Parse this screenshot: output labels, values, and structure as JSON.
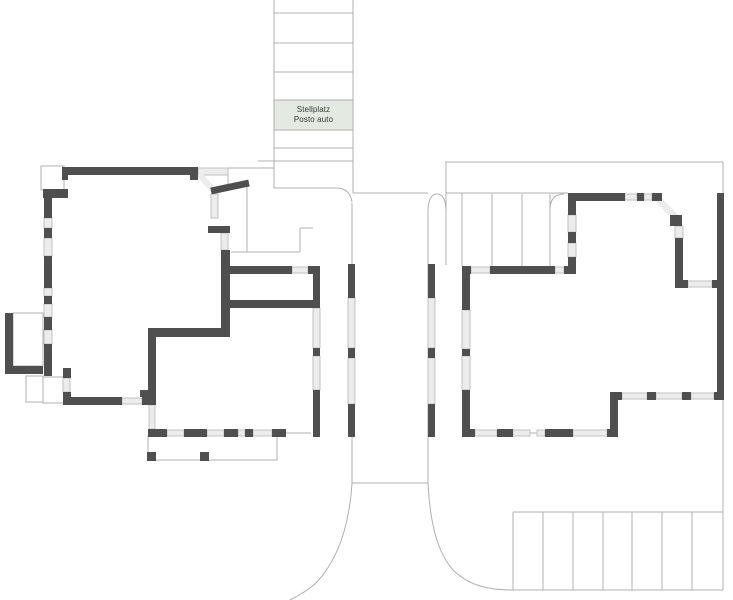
{
  "plan": {
    "width": 733,
    "height": 600,
    "colors": {
      "bg": "#ffffff",
      "wall": "#4f4f4f",
      "window_fill": "#ececec",
      "window_stroke": "#c2c2c2",
      "line": "#b0b0b0",
      "line_light": "#cccccc",
      "label_bg": "#e4e9e2",
      "label_text": "#3a3a3a"
    },
    "label": {
      "x": 274,
      "y": 100,
      "w": 79,
      "h": 30,
      "line1": "Stellplatz",
      "line2": "Posto auto"
    },
    "parking_top": {
      "x1": 274,
      "x2": 353,
      "dividers_y": [
        13,
        43,
        72,
        100,
        130,
        148,
        161
      ]
    },
    "parking_bottom": {
      "x1": 513,
      "x2": 723,
      "y1": 512,
      "y2": 590,
      "dividers_x": [
        513,
        543,
        573,
        603,
        632,
        662,
        692
      ]
    },
    "stairs": {
      "dividers_x": [
        492,
        522,
        550
      ],
      "y1": 194,
      "y2": 266
    },
    "thin_lines": [
      [
        198,
        168,
        274,
        168
      ],
      [
        228,
        168,
        228,
        184
      ],
      [
        274,
        0,
        274,
        188
      ],
      [
        353,
        0,
        353,
        193
      ],
      [
        258,
        161,
        353,
        161
      ],
      [
        352,
        203,
        352,
        484
      ],
      [
        428,
        212,
        428,
        483
      ],
      [
        352,
        483,
        428,
        483
      ],
      [
        353,
        193,
        428,
        193
      ],
      [
        446,
        162,
        446,
        265
      ],
      [
        446,
        193,
        568,
        193
      ],
      [
        462,
        193,
        462,
        266
      ],
      [
        445,
        162,
        723,
        162
      ],
      [
        723,
        162,
        723,
        590
      ],
      [
        513,
        512,
        723,
        512
      ],
      [
        507,
        590,
        723,
        590
      ],
      [
        285,
        433,
        311,
        433
      ],
      [
        530,
        433,
        538,
        433
      ],
      [
        231,
        252,
        300,
        252
      ],
      [
        300,
        228,
        300,
        252
      ],
      [
        300,
        228,
        313,
        228
      ],
      [
        247,
        186,
        247,
        252
      ]
    ],
    "thin_hairlines_light": [
      [
        197,
        173,
        211,
        188
      ],
      [
        655,
        196,
        676,
        217
      ],
      [
        661,
        202,
        682,
        223
      ]
    ],
    "thin_rects": [
      [
        41,
        166,
        23,
        24
      ],
      [
        13,
        313,
        30,
        53
      ],
      [
        26,
        376,
        17,
        26
      ],
      [
        43,
        377,
        22,
        26
      ],
      [
        148,
        436,
        129,
        24
      ]
    ],
    "curves": [
      "M274,188 L338,188 Q350,189 352,202",
      "M428,212 Q428,194 437,194 Q446,194 446,212",
      "M550,210 Q550,194 564,194",
      "M352,483 C349,530 336,562 316,583 C307,591 298,596 290,600",
      "M428,483 C430,522 437,553 454,571 C470,586 489,590 513,590"
    ],
    "walls": [
      [
        62,
        167,
        136,
        8
      ],
      [
        62,
        167,
        6,
        13
      ],
      [
        190,
        167,
        8,
        13
      ],
      [
        43,
        189,
        25,
        9
      ],
      [
        44,
        189,
        8,
        29
      ],
      [
        44,
        228,
        8,
        10
      ],
      [
        44,
        256,
        8,
        32
      ],
      [
        44,
        296,
        8,
        8
      ],
      [
        44,
        317,
        8,
        13
      ],
      [
        44,
        344,
        8,
        32
      ],
      [
        5,
        313,
        8,
        60
      ],
      [
        5,
        366,
        38,
        8
      ],
      [
        63,
        368,
        8,
        10
      ],
      [
        63,
        392,
        8,
        13
      ],
      [
        63,
        397,
        59,
        8
      ],
      [
        142,
        397,
        14,
        8
      ],
      [
        148,
        328,
        8,
        69
      ],
      [
        140,
        390,
        8,
        7
      ],
      [
        148,
        328,
        82,
        9
      ],
      [
        221,
        250,
        9,
        87
      ],
      [
        208,
        226,
        22,
        7
      ],
      [
        221,
        266,
        71,
        8
      ],
      [
        308,
        266,
        12,
        8
      ],
      [
        230,
        300,
        90,
        8
      ],
      [
        313,
        266,
        7,
        42
      ],
      [
        313,
        348,
        7,
        8
      ],
      [
        313,
        390,
        7,
        47
      ],
      [
        148,
        429,
        19,
        8
      ],
      [
        184,
        429,
        23,
        8
      ],
      [
        224,
        429,
        14,
        8
      ],
      [
        245,
        429,
        8,
        8
      ],
      [
        272,
        429,
        14,
        8
      ],
      [
        348,
        264,
        7,
        34
      ],
      [
        348,
        348,
        7,
        10
      ],
      [
        348,
        404,
        7,
        33
      ],
      [
        428,
        264,
        7,
        34
      ],
      [
        428,
        348,
        7,
        10
      ],
      [
        428,
        404,
        7,
        33
      ],
      [
        568,
        193,
        57,
        8
      ],
      [
        637,
        193,
        7,
        8
      ],
      [
        652,
        193,
        10,
        8
      ],
      [
        568,
        193,
        8,
        22
      ],
      [
        568,
        232,
        8,
        11
      ],
      [
        568,
        257,
        8,
        11
      ],
      [
        462,
        266,
        9,
        8
      ],
      [
        490,
        266,
        65,
        8
      ],
      [
        564,
        266,
        12,
        8
      ],
      [
        462,
        268,
        8,
        42
      ],
      [
        462,
        349,
        8,
        7
      ],
      [
        462,
        390,
        8,
        47
      ],
      [
        670,
        215,
        12,
        11
      ],
      [
        675,
        238,
        8,
        49
      ],
      [
        675,
        280,
        13,
        8
      ],
      [
        712,
        280,
        12,
        8
      ],
      [
        717,
        193,
        7,
        207
      ],
      [
        610,
        392,
        12,
        8
      ],
      [
        647,
        392,
        9,
        8
      ],
      [
        682,
        392,
        9,
        8
      ],
      [
        714,
        392,
        10,
        8
      ],
      [
        610,
        398,
        8,
        39
      ],
      [
        462,
        429,
        13,
        8
      ],
      [
        497,
        429,
        16,
        8
      ],
      [
        545,
        429,
        28,
        8
      ],
      [
        607,
        429,
        11,
        8
      ]
    ],
    "wall_bands": [
      {
        "d": "M211,191 L249,183",
        "w": 7
      }
    ],
    "windows": [
      [
        198,
        168,
        30,
        7
      ],
      [
        44,
        218,
        8,
        10
      ],
      [
        44,
        238,
        8,
        18
      ],
      [
        44,
        288,
        8,
        8
      ],
      [
        44,
        304,
        8,
        13
      ],
      [
        44,
        330,
        8,
        14
      ],
      [
        63,
        378,
        7,
        14
      ],
      [
        122,
        398,
        20,
        6
      ],
      [
        149,
        405,
        6,
        24
      ],
      [
        211,
        194,
        7,
        24
      ],
      [
        221,
        233,
        7,
        17
      ],
      [
        292,
        267,
        16,
        6
      ],
      [
        313,
        308,
        7,
        40
      ],
      [
        313,
        356,
        7,
        34
      ],
      [
        167,
        430,
        17,
        6
      ],
      [
        207,
        430,
        17,
        6
      ],
      [
        238,
        430,
        7,
        6
      ],
      [
        253,
        430,
        19,
        6
      ],
      [
        348,
        298,
        7,
        50
      ],
      [
        348,
        358,
        7,
        46
      ],
      [
        428,
        298,
        7,
        50
      ],
      [
        428,
        358,
        7,
        46
      ],
      [
        625,
        194,
        12,
        6
      ],
      [
        644,
        194,
        8,
        6
      ],
      [
        568,
        215,
        8,
        17
      ],
      [
        568,
        243,
        8,
        14
      ],
      [
        471,
        267,
        19,
        6
      ],
      [
        555,
        267,
        9,
        6
      ],
      [
        462,
        310,
        8,
        39
      ],
      [
        462,
        356,
        8,
        34
      ],
      [
        675,
        226,
        8,
        12
      ],
      [
        688,
        281,
        24,
        6
      ],
      [
        622,
        393,
        25,
        6
      ],
      [
        656,
        393,
        26,
        6
      ],
      [
        691,
        393,
        23,
        6
      ],
      [
        475,
        430,
        22,
        6
      ],
      [
        513,
        430,
        17,
        6
      ],
      [
        537,
        430,
        8,
        6
      ],
      [
        573,
        430,
        34,
        6
      ]
    ],
    "window_bands": [
      {
        "d": "M199,174 L212,189",
        "w": 6
      },
      {
        "d": "M658,199 L679,221",
        "w": 7
      }
    ],
    "posts": [
      [
        147,
        452,
        9,
        9
      ],
      [
        200,
        452,
        9,
        9
      ]
    ]
  }
}
